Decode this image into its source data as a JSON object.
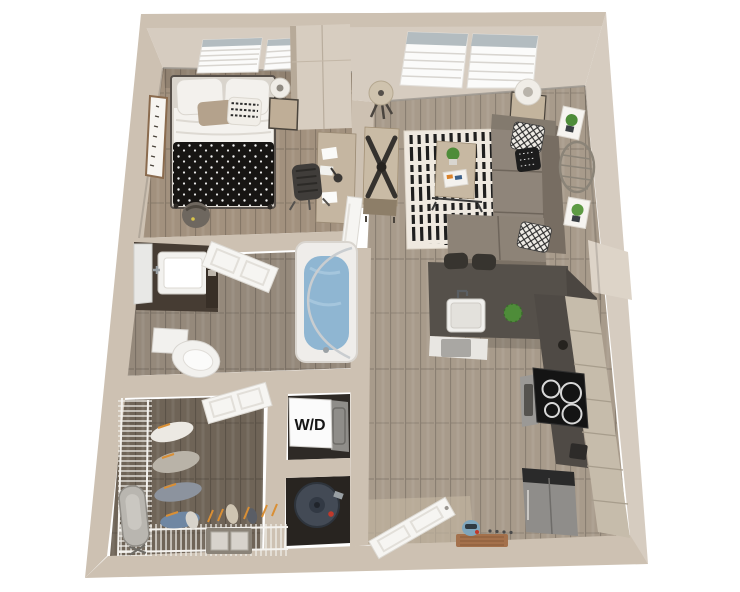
{
  "floorplan": {
    "laundry_label": "W/D",
    "regions": [
      "bedroom",
      "bathroom",
      "walk-in-closet",
      "laundry-closet",
      "water-heater-closet",
      "living-room",
      "dining-area",
      "kitchen",
      "entry"
    ],
    "colors": {
      "wall": "#cdc1b2",
      "wall-light": "#ddd4c8",
      "wall-face": "#d6ccc0",
      "floor-main": "#a89b8b",
      "floor-bed": "#a2917e",
      "floor-bath": "#95897b",
      "floor-closet": "#6f6457",
      "counter": "#55504a",
      "cabinet": "#c6bcab",
      "sofa": "#8f857a",
      "sofa-dark": "#776d62",
      "rug": "#efe9e0",
      "stripe": "#1f1f1f",
      "duvet": "#171513",
      "water": "#8fb6d2",
      "heater": "#434a55",
      "plant": "#4e8c39",
      "accent": "#d98f35",
      "door": "#f6f5f2",
      "fixture": "#f2f1ee"
    }
  }
}
